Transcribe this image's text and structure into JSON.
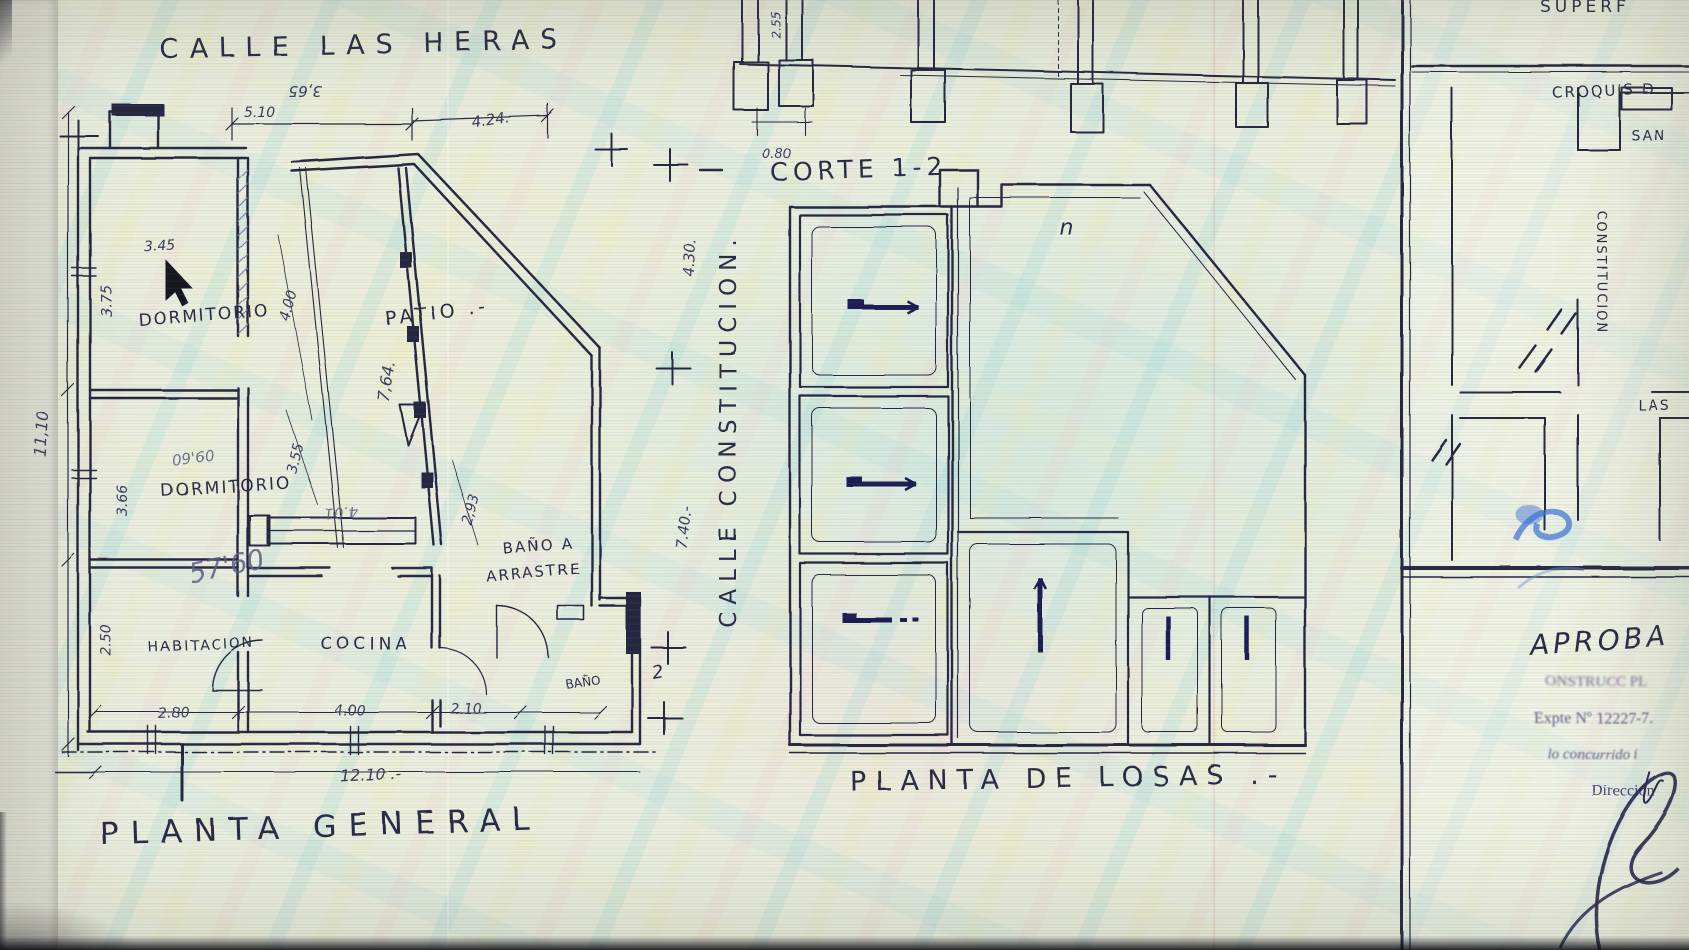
{
  "colors": {
    "paper": "#ecefe0",
    "ink": "#26273f",
    "pencil": "#5a5c82",
    "blue_ink": "#3b6fd6",
    "arrow_ink": "#1f1a55"
  },
  "fp": {
    "street_top": "CALLE LAS HERAS",
    "title": "PLANTA GENERAL",
    "rooms": {
      "dormitorio1": "DORMITORIO",
      "dormitorio2": "DORMITORIO",
      "habitacion": "HABITACION",
      "cocina": "COCINA",
      "banio": "BAÑO",
      "banio_num": "2",
      "patio": "PATIO .-",
      "arrastre1": "BAÑO A",
      "arrastre2": "ARRASTRE"
    },
    "dims": {
      "top_total": "3,65",
      "top_a": "5.10",
      "top_b": "4.24.",
      "width_d1": "3.45",
      "left_a": "3.75",
      "left_b": "3.66",
      "left_c": "2.50",
      "left_total": "11,10",
      "diag_a": "4.00",
      "diag_b": "3.55",
      "diag_c": "2,93",
      "patio_len": "7,64.",
      "bottom_a": "2.80",
      "bottom_b": "4.00",
      "bottom_c": "2.10",
      "bottom_total": "12.10 .-",
      "right_a": "4.30.",
      "right_b": "7.40.-",
      "pencil_a": "09'60",
      "pencil_b": "57'60",
      "pencil_c": "4.01"
    }
  },
  "street_right": "CALLE CONSTITUCION.",
  "section": {
    "title": "CORTE 1-2",
    "dim_footing": "0.80",
    "dim_top": "2.55"
  },
  "slab": {
    "title": "PLANTA DE LOSAS .-",
    "mark": "n"
  },
  "tb": {
    "superf": "SUPERF",
    "croquis": "CROQUIS D",
    "san": "SAN",
    "constitucion": "CONSTITUCION",
    "las": "LAS",
    "aprobado": "APROBA",
    "stamp1": "ONSTRUCC  PL",
    "expte": "Expte Nº 12227-7.",
    "stamp3": "lo concurrido i",
    "direccion": "Dirección"
  }
}
